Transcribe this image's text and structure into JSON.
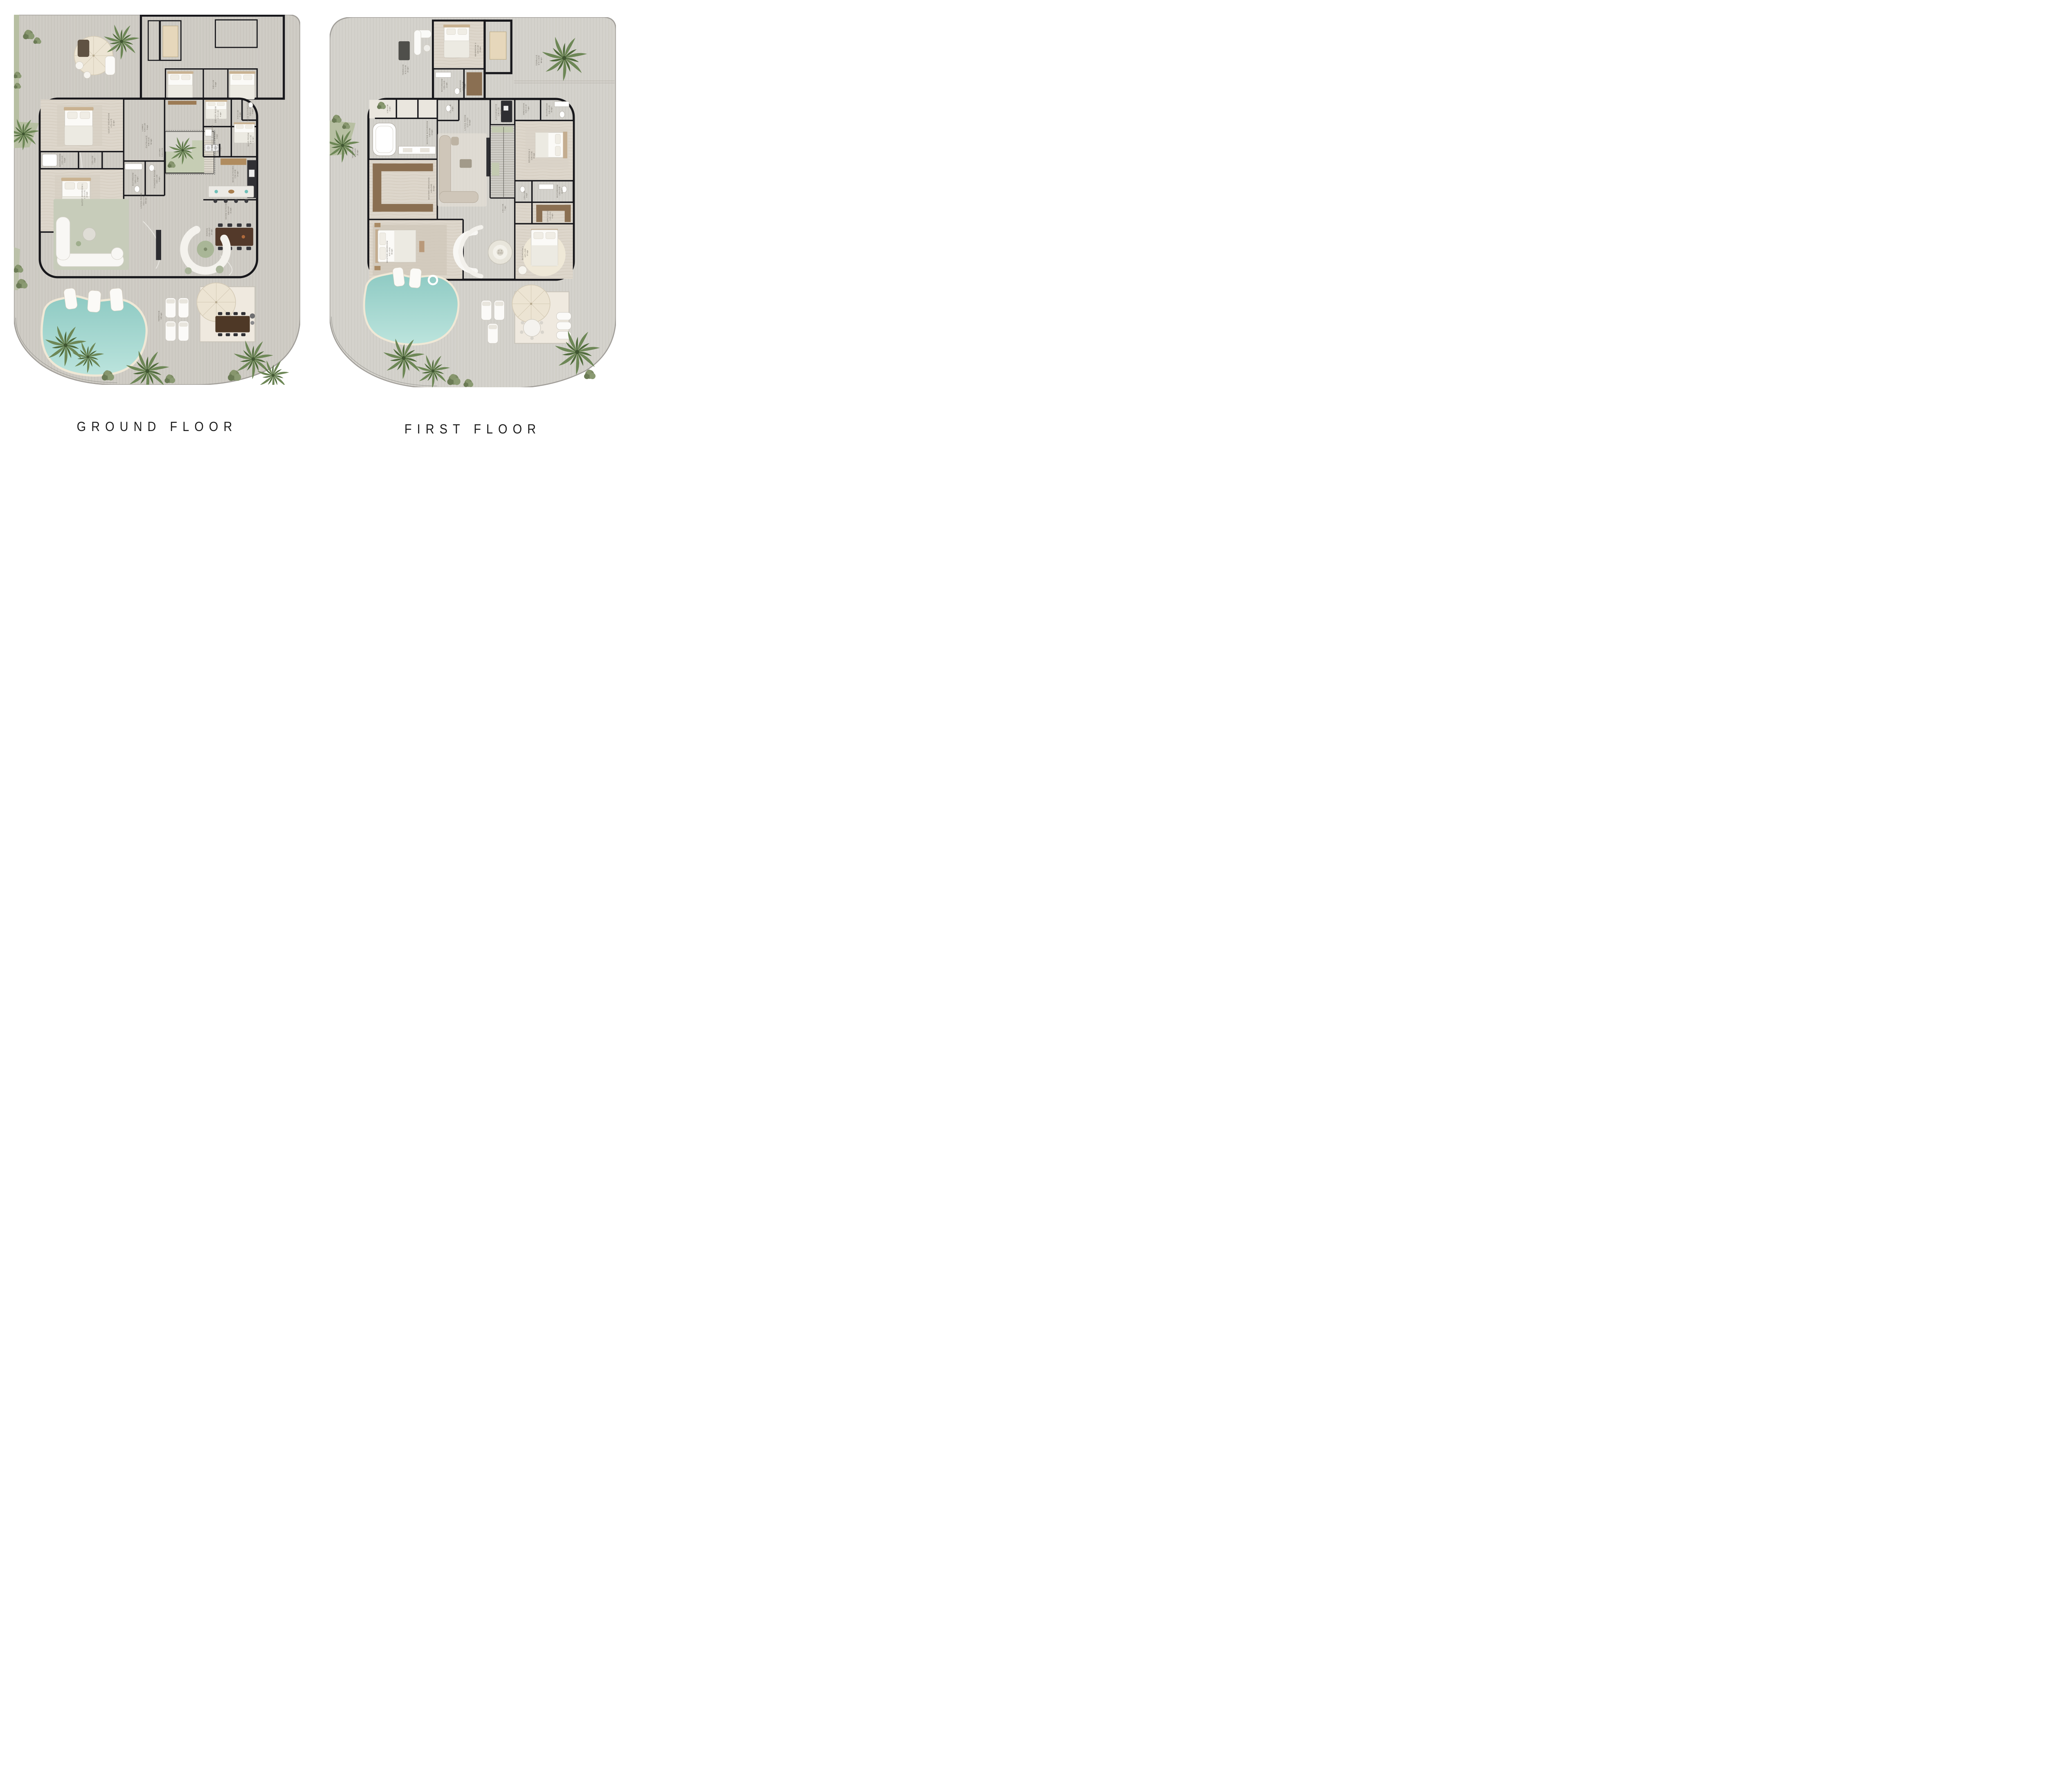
{
  "document": {
    "type": "architectural floor plans",
    "background": "#ffffff"
  },
  "palette": {
    "deck_ground": "#cfccc5",
    "deck_first": "#d4d2cc",
    "wall": "#17171b",
    "marble": "#f5f4f1",
    "stone_bedroom": "#ddd6cb",
    "bath": "#eae6de",
    "garage": "#c8c8c6",
    "pool_deep": "#8ecac3",
    "pool_shallow": "#bce4dd",
    "pool_border": "#f0e8d6",
    "grass": "#b7bfa2",
    "palm": "#6d8756",
    "wood_wardrobe": "#8a6f52",
    "label_text": "#6e6960",
    "title_text": "#1b1b1b"
  },
  "floors": [
    {
      "title": "GROUND FLOOR",
      "labels": [
        {
          "name": "ENTRANCE",
          "dims": "9.66 x 5.41",
          "area": "52 sqm"
        },
        {
          "name": "LIVING ROOM",
          "dims": "9.01 x 17.32",
          "area": "156 sqm"
        },
        {
          "name": "DINING",
          "dims": "6.93 x 5.97",
          "area": "37 sqm"
        },
        {
          "name": "SHOW KITCHEN",
          "dims": "3.50 x 5.97",
          "area": "21 sqm"
        },
        {
          "name": "MAIN KITCHEN",
          "dims": "2.34 x 5.60",
          "area": "14 sqm"
        },
        {
          "name": "LAUNDRY",
          "dims": "1.80 x 3.35",
          "area": "6 sqm"
        },
        {
          "name": "GUEST BEDROOM",
          "dims": "4.70 x 4.75",
          "area": "22 sqm"
        },
        {
          "name": "GUEST BEDROOM 1",
          "dims": "4.75 x 4.70",
          "area": "22 sqm"
        },
        {
          "name": "BATHROOM",
          "dims": "2.99 x 2.10",
          "area": "6 sqm"
        },
        {
          "name": "BATHROOM",
          "dims": "3.05 x 2.10",
          "area": "6 sqm"
        },
        {
          "name": "POWDER ROOM",
          "dims": "3.05 x 1.95",
          "area": "6 sqm"
        },
        {
          "name": "LOBBY",
          "dims": "4.44 x 1.95",
          "area": "9 sqm"
        },
        {
          "name": "STAIRS",
          "dims": "9.44 x 2.70",
          "area": ""
        },
        {
          "name": "MAID ROOM",
          "dims": "4.36 x 2.35",
          "area": "10 sqm"
        },
        {
          "name": "MAID BATHROOM",
          "dims": "2.00 x 1.70",
          "area": "3 sqm"
        },
        {
          "name": "DRIVER ROOM",
          "dims": "2.72 x 1.32",
          "area": "4 sqm"
        },
        {
          "name": "DRIVER BATHROOM",
          "dims": "1.69 x 2.05",
          "area": "3 sqm"
        },
        {
          "name": "TERRACE",
          "dims": "545 sqm",
          "area": ""
        },
        {
          "name": "",
          "dims": "3.69 x 1.20",
          "area": "5 sqm"
        },
        {
          "name": "",
          "dims": "1.50 x 2.30",
          "area": "3 sqm"
        },
        {
          "name": "",
          "dims": "2.72 x 1.20",
          "area": "3 sqm"
        }
      ]
    },
    {
      "title": "FIRST FLOOR",
      "labels": [
        {
          "name": "TERRACE",
          "dims": "8.73 x 3.33",
          "area": "29 sqm"
        },
        {
          "name": "BEDROOM 3",
          "dims": "4.90 x 5.40",
          "area": "26 sqm"
        },
        {
          "name": "BATHROOM",
          "dims": "3.58 x 3.20",
          "area": "11 sqm"
        },
        {
          "name": "DRESSING",
          "dims": "3.73 x 2.00",
          "area": "6 sqm"
        },
        {
          "name": "TERRACE",
          "dims": "8.72 x 10.09",
          "area": "88 sqm"
        },
        {
          "name": "KITCHENETTE",
          "dims": "2.36 x 2.55",
          "area": "6 sqm"
        },
        {
          "name": "LIVING ROOM",
          "dims": "11.57 x 5.53",
          "area": "64 sqm"
        },
        {
          "name": "MASTER BATHROOM",
          "dims": "2.39 x 6.08",
          "area": "14 sqm"
        },
        {
          "name": "MASTER DRESSING",
          "dims": "4.25 x 5.93",
          "area": "25 sqm"
        },
        {
          "name": "MASTER BEDROOM",
          "dims": "9.97 x 9.01",
          "area": "90 sqm"
        },
        {
          "name": "BEDROOM 2",
          "dims": "4.98 x 5.85",
          "area": "29 sqm"
        },
        {
          "name": "DRESSING",
          "dims": "3.20 x 2.10",
          "area": "7 sqm"
        },
        {
          "name": "BATHROOM",
          "dims": "3.30 x 3.05",
          "area": "10 sqm"
        },
        {
          "name": "BATHROOM",
          "dims": "2.60 x 3.48",
          "area": "10 sqm"
        },
        {
          "name": "BEDROOM 1",
          "dims": "4.87 x 5.85",
          "area": "27 sqm"
        },
        {
          "name": "DRESSING",
          "dims": "2.40 x 3.91",
          "area": "9 sqm"
        },
        {
          "name": "TERRACE",
          "dims": "8.73 x 3.01",
          "area": "26 sqm"
        },
        {
          "name": "",
          "dims": "2.93 x 2.55",
          "area": "7 sqm"
        },
        {
          "name": "",
          "dims": "1.78 x 1.85",
          "area": "3 sqm"
        },
        {
          "name": "",
          "dims": "1.64 x 1.85",
          "area": "3 sqm"
        },
        {
          "name": "",
          "dims": "1.71 x 1.60",
          "area": "3 sqm"
        }
      ]
    }
  ]
}
